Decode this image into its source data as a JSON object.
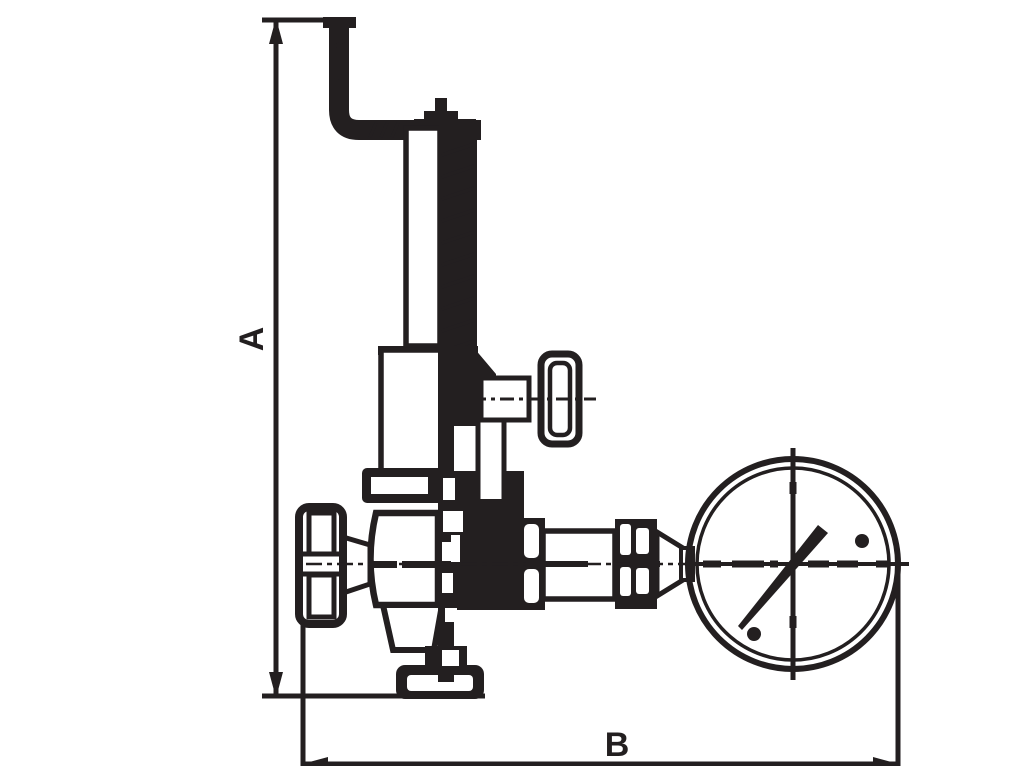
{
  "canvas": {
    "width": 1024,
    "height": 766,
    "background": "#ffffff",
    "line_color": "#231f20"
  },
  "drawing": {
    "kind": "technical line drawing",
    "subject": "spring-loaded valve with lever, handwheel and pressure gauge",
    "dimension_labels": {
      "vertical": "A",
      "horizontal": "B"
    },
    "parts": [
      "lever-handle",
      "spring-bonnet",
      "adjustment-spring",
      "side-knob",
      "inlet-handwheel",
      "valve-body",
      "outlet-flange",
      "gauge-piping",
      "pressure-gauge",
      "gauge-needle"
    ]
  }
}
